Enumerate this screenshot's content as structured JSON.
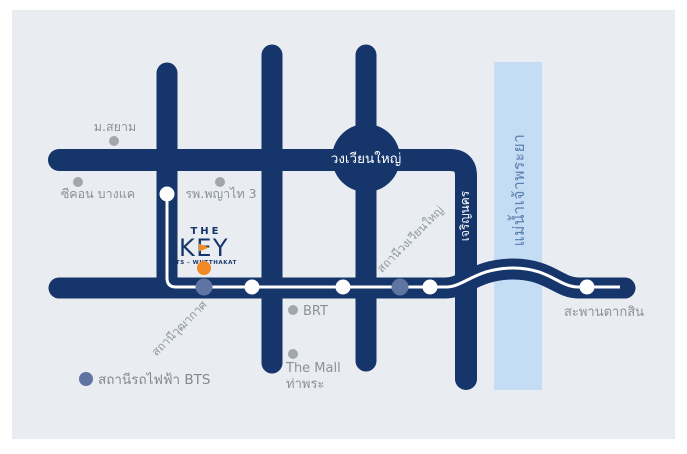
{
  "map": {
    "project_logo": {
      "line1": "THE",
      "line2": "KEY",
      "line3": "BTS - WUTTHAKAT"
    },
    "roads": {
      "wongwian_yai_roundabout": "วงเวียนใหญ่",
      "charoen_nakhon_road": "เจริญนคร"
    },
    "river": {
      "chao_phraya": "แม่น้ำเจ้าพระยา"
    },
    "stations": {
      "wutthakat": "สถานีวุฒากาศ",
      "wongwian_yai": "สถานีวงเวียนใหญ่"
    },
    "landmarks": {
      "siam_university": "ม.สยาม",
      "seacon_bangkae": "ซีคอน บางแค",
      "phyathai_3_hospital": "รพ.พญาไท 3",
      "brt": "BRT",
      "the_mall_line1": "The Mall",
      "the_mall_line2": "ท่าพระ",
      "taksin_bridge": "สะพานตากสิน"
    },
    "legend": {
      "bts_station": "สถานีรถไฟฟ้า BTS"
    },
    "colors": {
      "road_navy": "#16356b",
      "map_background": "#e9edf1",
      "river_blue": "#c5ddf4",
      "river_text_blue": "#5d80b1",
      "bts_station_dot": "#5f74a3",
      "landmark_dot": "#a1a7ac",
      "label_gray": "#8b9196",
      "brand_orange": "#ef8a24",
      "bts_line_white": "#ffffff"
    }
  }
}
